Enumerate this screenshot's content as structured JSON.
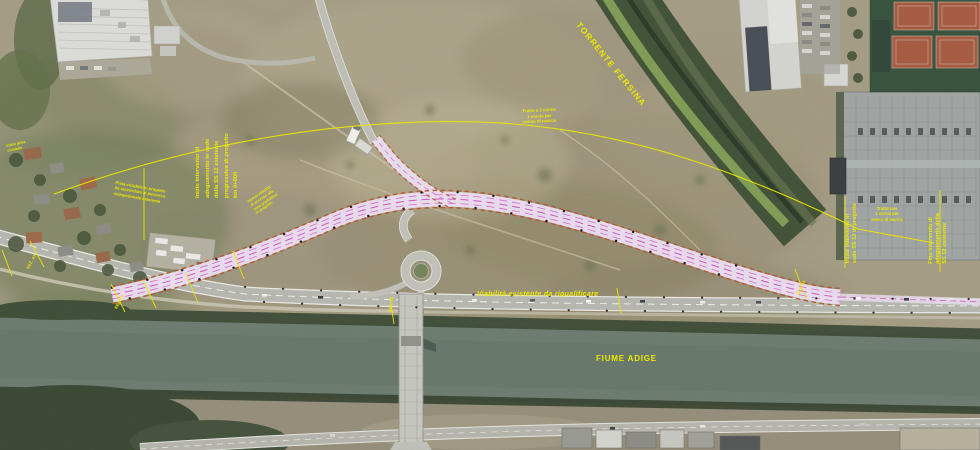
{
  "labels": {
    "stream": "TORRENTE FERSINA",
    "river": "FIUME ADIGE",
    "road": "Viabilità esistente da riqualificare"
  },
  "annotations": {
    "left_works_block": {
      "lines": [
        "Inizio intervento di",
        "adeguamento in sede",
        "della SS 12 esistente",
        "progressiva di progetto",
        "km 0+000"
      ]
    },
    "bike_path_note": {
      "lines": [
        "Pista ciclabile in progetto",
        "da raccordare al percorso",
        "ciclopedonale esistente"
      ]
    },
    "access_road_note": {
      "lines": [
        "Nuova viabilità",
        "di accesso alla",
        "zona produttiva",
        "in progetto"
      ]
    },
    "carriageway_note": {
      "lines": [
        "Tratto a 2 corsie",
        "1 corsia per",
        "senso di marcia"
      ]
    },
    "right_carriageway_note": {
      "lines": [
        "Tratto con",
        "1 corsia per",
        "senso di marcia"
      ]
    },
    "project_start_note": {
      "lines": [
        "Inizio intervento in",
        "sede SS 12 di progetto"
      ]
    },
    "project_end_note": {
      "lines": [
        "Fine intervento di",
        "adeguamento della",
        "SS 12 esistente"
      ]
    },
    "bike_start_note": {
      "lines": [
        "Inizio pista",
        "ciclabile"
      ]
    }
  },
  "section_markers": [
    "SEZ. 41",
    "SEZ. 42",
    "SEZ. 45",
    "SEZ. 52"
  ],
  "colors": {
    "annotation_yellow": "#ece800",
    "project_pink": "#ece0f2",
    "project_magenta": "#cf4fc4",
    "works_edge_orange": "#b55a33",
    "river_green": "#6f7e72",
    "terrain_tan": "#a69e86"
  }
}
